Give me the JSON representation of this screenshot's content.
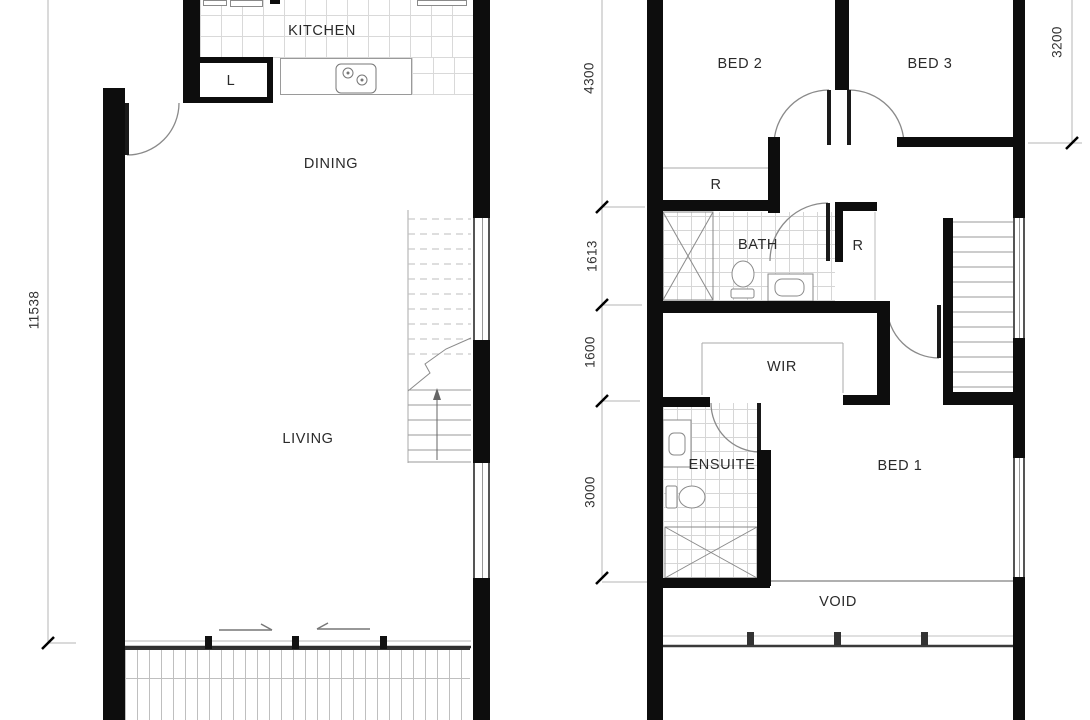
{
  "plan": {
    "left": {
      "rooms": {
        "kitchen": "KITCHEN",
        "laundry": "L",
        "dining": "DINING",
        "living": "LIVING"
      },
      "dimensions": {
        "total_depth": "11538"
      }
    },
    "right": {
      "rooms": {
        "bed2": "BED 2",
        "bed3": "BED 3",
        "robe_bed2": "R",
        "bath": "BATH",
        "robe_bath": "R",
        "wir": "WIR",
        "ensuite": "ENSUITE",
        "bed1": "BED 1",
        "void": "VOID"
      },
      "dimensions": {
        "bed_zone": "4300",
        "bath_zone": "1613",
        "wir_zone": "1600",
        "bed1_zone": "3000",
        "bed3_depth": "3200"
      }
    },
    "colors": {
      "wall": "#0d0d0d",
      "line": "#888888",
      "tile_line": "#d9d9d9",
      "text": "#2a2a2a"
    },
    "icons": {
      "cooktop": "cooktop-icon",
      "toilet": "toilet-icon",
      "shower": "shower-icon",
      "basin": "basin-icon",
      "stairs": "stairs-icon",
      "door": "door-swing-icon",
      "sliding_door": "sliding-door-icon",
      "balustrade": "balustrade-icon"
    }
  }
}
